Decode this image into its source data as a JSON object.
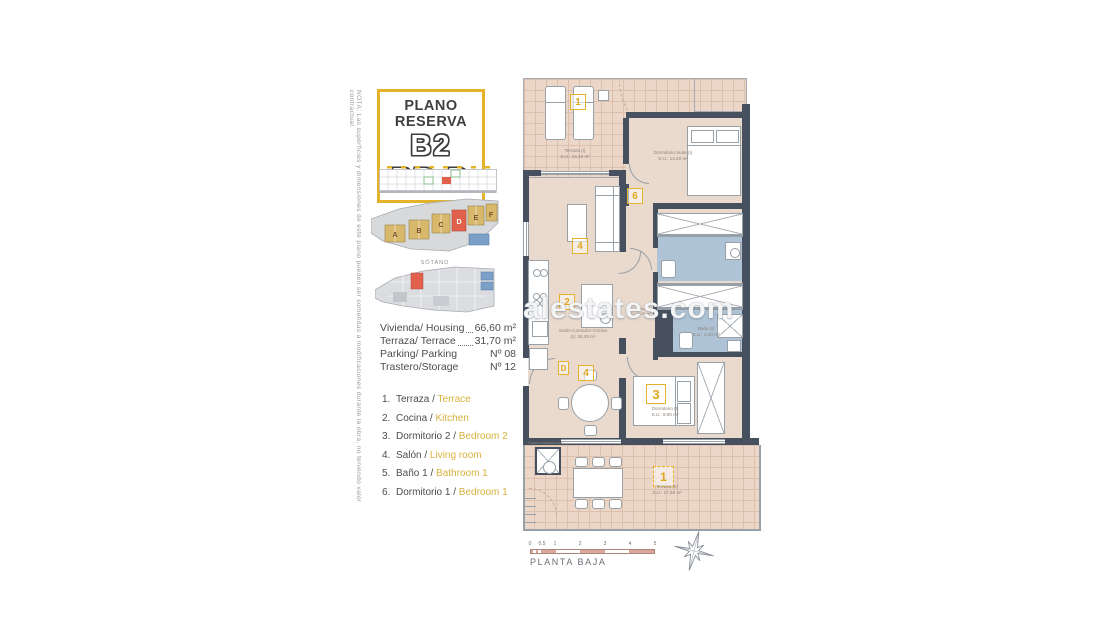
{
  "note": "NOTA: Las superficies y dimensiones de este plano pueden ser sometidas a modificaciones durante la obra, no teniendo valor contractual.",
  "title": {
    "kicker": "PLANO RESERVA",
    "code": "B2 PB-D"
  },
  "colors": {
    "accent_yellow": "#E5B32A",
    "wall": "#46505F",
    "room_floor": "#E9DACD",
    "terrace_floor": "#EBD6C7",
    "bath_floor": "#AFC3D6",
    "highlight_orange": "#E2614D",
    "block_yellow": "#D8B96B",
    "block_blue": "#7B9FC7",
    "scale_pink": "#D9A79C",
    "legend_english": "#D8B23D"
  },
  "thumbnails": {
    "blocks": {
      "a": "A",
      "b": "B",
      "c": "C",
      "d": "D",
      "e": "E",
      "f": "F"
    },
    "basement_label": "SÓTANO"
  },
  "info": {
    "rows": [
      {
        "label": "Vivienda/ Housing",
        "value": "66,60 m²"
      },
      {
        "label": "Terraza/ Terrace",
        "value": "31,70 m²"
      },
      {
        "label": "Parking/ Parking",
        "value": "Nº 08"
      },
      {
        "label": "Trastero/Storage",
        "value": "Nº 12"
      }
    ]
  },
  "legend": {
    "items": [
      {
        "num": "1.",
        "es": "Terraza /",
        "en": "Terrace"
      },
      {
        "num": "2.",
        "es": "Cocina /",
        "en": "Kitchen"
      },
      {
        "num": "3.",
        "es": "Dormitorio 2 /",
        "en": "Bedroom 2"
      },
      {
        "num": "4.",
        "es": "Salón /",
        "en": "Living room"
      },
      {
        "num": "5.",
        "es": "Baño 1 /",
        "en": "Bathroom 1"
      },
      {
        "num": "6.",
        "es": "Dormitorio 1 /",
        "en": "Bedroom 1"
      }
    ]
  },
  "plan": {
    "watermark": "alestates.com",
    "caption": "PLANTA BAJA",
    "badges": {
      "terrace1": "1",
      "suite": "6",
      "living": "4",
      "kitchen": "2",
      "door": "D",
      "dining": "4",
      "bedroom": "3",
      "terrace2": "1"
    },
    "rooms": {
      "terrace_top": {
        "name": "Terraza (I)",
        "area": "S.U.: 14,10 m²"
      },
      "suite": {
        "name": "Dormitorio Suite (I)",
        "area": "S.U.: 14,20 m²"
      },
      "living": {
        "name": "Salón-Comedor-Cocina",
        "area": "(I): 26,30 m²"
      },
      "hall": {
        "name": "Distribuidor (I)",
        "area": "S.U.: 2,20 m²"
      },
      "bath": {
        "name": "Baño (I)",
        "area": "S.U.: 3,40 m²"
      },
      "bedroom": {
        "name": "Dormitorio (I)",
        "area": "S.U.: 8,90 m²"
      },
      "terrace_bottom": {
        "name": "Terraza (II)",
        "area": "S.U.: 17,60 m²"
      },
      "utility": {
        "name": "Cuarto instalaciones",
        "area": ""
      }
    },
    "scale": {
      "ticks": [
        "0",
        "0.5",
        "1",
        "2",
        "3",
        "4",
        "5"
      ]
    }
  }
}
